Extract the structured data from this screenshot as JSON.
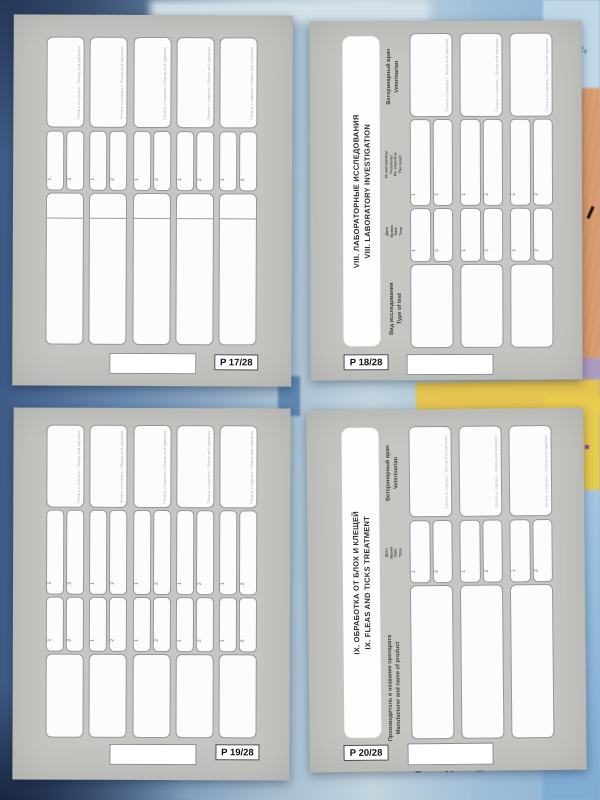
{
  "background": {
    "ocean_label": "ОКЕАН",
    "sea_label": "ЛА"
  },
  "labels": {
    "stamp": "Печать и подпись / Stamp and signature",
    "one": "1",
    "two": "2"
  },
  "pages": {
    "p17": {
      "number": "P 17/28"
    },
    "p18": {
      "number": "P 18/28",
      "title": {
        "ru": "VIII. ЛАБОРАТОРНЫЕ ИССЛЕДОВАНИЯ",
        "en": "VIII. LABORATORY INVESTIGATION"
      },
      "headers": {
        "veterinarian": {
          "ru": "Ветеринарный врач",
          "en": "Veterinarian"
        },
        "result": {
          "ru1": "№ экспертизы",
          "ru2": "Результат",
          "en1": "No. expertise",
          "en2": "The result"
        },
        "date": {
          "ru1": "Дата",
          "ru2": "Время",
          "en1": "Date",
          "en2": "Time"
        },
        "test": {
          "ru": "Вид исследования",
          "en": "Type of test"
        }
      }
    },
    "p19": {
      "number": "P 19/28"
    },
    "p20": {
      "number": "P 20/28",
      "title": {
        "ru": "IX. ОБРАБОТКА ОТ БЛОХ И КЛЕЩЕЙ",
        "en": "IX. FLEAS AND TICKS TREATMENT"
      },
      "headers": {
        "veterinarian": {
          "ru": "Ветеринарный врач",
          "en": "Veterinarian"
        },
        "date": {
          "ru1": "Дата",
          "ru2": "Время",
          "en1": "Date",
          "en2": "Time"
        },
        "product": {
          "ru": "Производитель и название препарата",
          "en": "Manufacturer and name of product"
        }
      }
    }
  }
}
